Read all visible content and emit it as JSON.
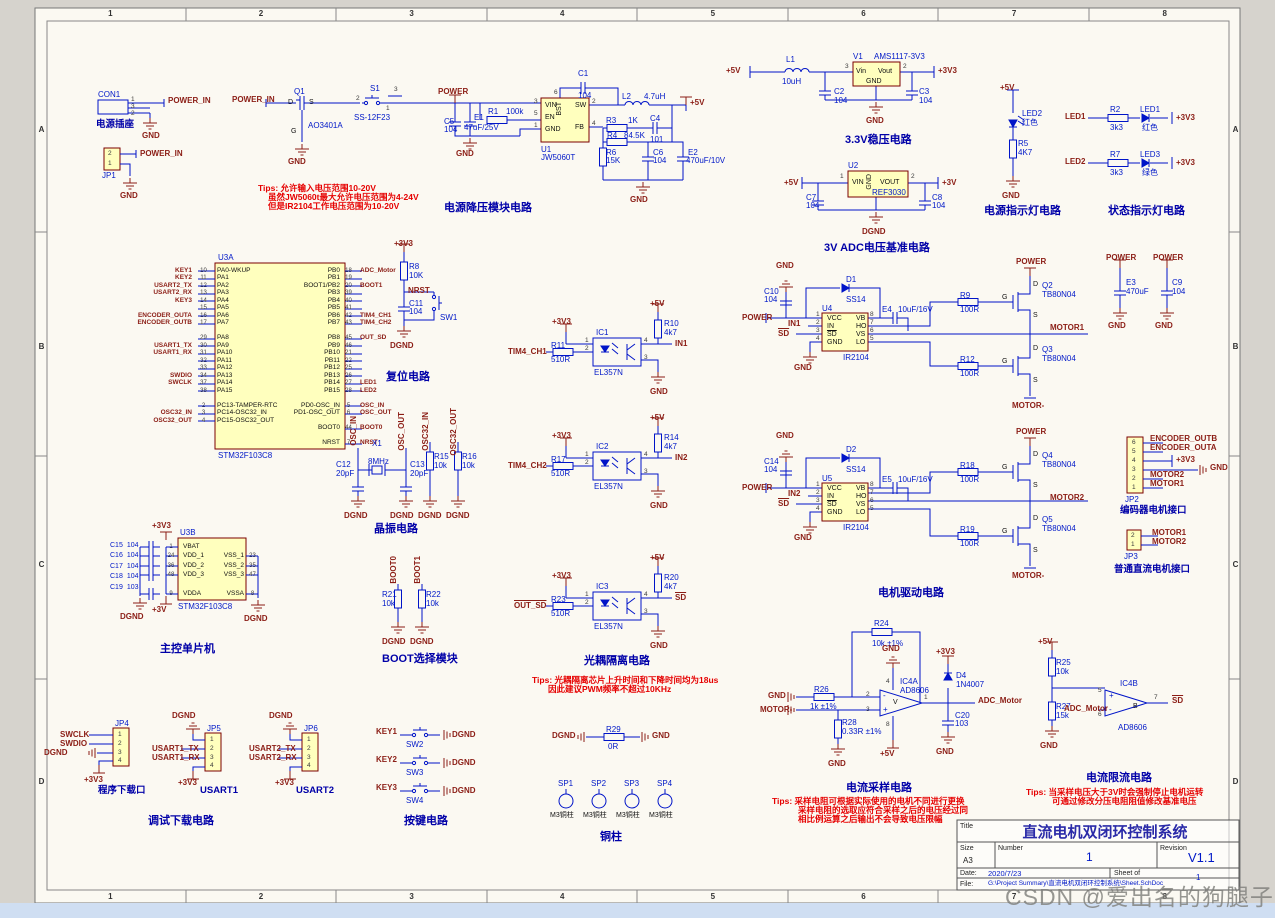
{
  "page": {
    "watermark": "CSDN @爱出名的狗腿子",
    "frame_cols": [
      "1",
      "2",
      "3",
      "4",
      "5",
      "6",
      "7",
      "8"
    ],
    "frame_rows": [
      "A",
      "B",
      "C",
      "D"
    ],
    "colors": {
      "wire": "#0014c8",
      "net_label": "#8b1d15",
      "ic_fill": "#ffffbe",
      "ic_border": "#7b0000",
      "section_title": "#0000a8",
      "tip": "#e60000",
      "sheet": "#fbf9f2"
    }
  },
  "pi": {
    "con1": "CON1",
    "jack_label": "电源插座",
    "p1": "1",
    "p3": "3",
    "p2": "2",
    "net": "POWER_IN",
    "gnd": "GND",
    "jp1": "JP1",
    "jp1_p2": "2",
    "jp1_p1": "1",
    "jp1_net": "POWER_IN",
    "jp1_gnd": "GND"
  },
  "bk": {
    "title": "电源降压模块电路",
    "in_net": "POWER_IN",
    "q1": "Q1",
    "q1v": "AO3401A",
    "q1_d": "D",
    "q1_g": "G",
    "q1_s": "S",
    "q1_gnd": "GND",
    "s1": "S1",
    "s1v": "SS-12F23",
    "s1_p1": "1",
    "s1_p2": "2",
    "s1_p3": "3",
    "power": "POWER",
    "c5": "C5",
    "c5v": "104",
    "e1": "E1",
    "e1v": "47uF/25V",
    "r1": "R1",
    "r1v": "100k",
    "u1": "U1",
    "u1v": "JW5060T",
    "vin": "VIN",
    "en": "EN",
    "gnd": "GND",
    "bst": "BST",
    "sw": "SW",
    "fb": "FB",
    "n3": "3",
    "n5": "5",
    "n1": "1",
    "n6": "6",
    "n2": "2",
    "n4": "4",
    "c1": "C1",
    "c1v": "104",
    "l2": "L2",
    "l2v": "4.7uH",
    "out": "+5V",
    "r3": "R3",
    "r3v": "1K",
    "c4": "C4",
    "c4v": "101",
    "r4": "R4",
    "r4v": "84.5K",
    "r6": "R6",
    "r6v": "15K",
    "c6": "C6",
    "c6v": "104",
    "e2": "E2",
    "e2v": "470uF/10V",
    "gnd2": "GND",
    "gnd3": "GND",
    "tip1": "Tips: 允许输入电压范围10-20V",
    "tip2": "虽然JW5060t最大允许电压范围为4-24V",
    "tip3": "但是IR2104工作电压范围为10-20V"
  },
  "ldo": {
    "title": "3.3V稳压电路",
    "in": "+5V",
    "l1": "L1",
    "l1v": "10uH",
    "v1": "V1",
    "v1v": "AMS1117-3V3",
    "vin": "Vin",
    "vout": "Vout",
    "gnd": "GND",
    "n3": "3",
    "n2": "2",
    "c2": "C2",
    "c2v": "104",
    "c3": "C3",
    "c3v": "104",
    "out": "+3V3",
    "gndlbl": "GND"
  },
  "ref": {
    "title": "3V ADC电压基准电路",
    "u2": "U2",
    "u2v": "REF3030",
    "vin": "VIN",
    "vout": "VOUT",
    "gnd": "GND",
    "n1": "1",
    "n2": "2",
    "in": "+5V",
    "out": "+3V",
    "c7": "C7",
    "c7v": "104",
    "c8": "C8",
    "c8v": "104",
    "dgnd": "DGND"
  },
  "pled": {
    "title": "电源指示灯电路",
    "vcc": "+5V",
    "led": "LED2",
    "color": "红色",
    "r5": "R5",
    "r5v": "4K7",
    "gnd": "GND"
  },
  "sled": {
    "title": "状态指示灯电路",
    "rows": [
      {
        "net": "LED1",
        "r": "R2",
        "rv": "3k3",
        "led": "LED1",
        "color": "红色",
        "vcc": "+3V3"
      },
      {
        "net": "LED2",
        "r": "R7",
        "rv": "3k3",
        "led": "LED3",
        "color": "绿色",
        "vcc": "+3V3"
      }
    ]
  },
  "mcu": {
    "u3a": "U3A",
    "part": "STM32F103C8",
    "title": "主控单片机",
    "u3b": "U3B",
    "partb": "STM32F103C8",
    "vcc": "+3V3",
    "vdda": "+3V",
    "dgndl": "DGND",
    "dgndr": "DGND",
    "left": [
      {
        "net": "KEY1",
        "pin": "10",
        "name": "PA0-WKUP"
      },
      {
        "net": "KEY2",
        "pin": "11",
        "name": "PA1"
      },
      {
        "net": "USART2_TX",
        "pin": "12",
        "name": "PA2"
      },
      {
        "net": "USART2_RX",
        "pin": "13",
        "name": "PA3"
      },
      {
        "net": "KEY3",
        "pin": "14",
        "name": "PA4"
      },
      {
        "net": "",
        "pin": "15",
        "name": "PA5"
      },
      {
        "net": "ENCODER_OUTA",
        "pin": "16",
        "name": "PA6"
      },
      {
        "net": "ENCODER_OUTB",
        "pin": "17",
        "name": "PA7"
      },
      {
        "net": "",
        "pin": "",
        "name": ""
      },
      {
        "net": "",
        "pin": "29",
        "name": "PA8"
      },
      {
        "net": "USART1_TX",
        "pin": "30",
        "name": "PA9"
      },
      {
        "net": "USART1_RX",
        "pin": "31",
        "name": "PA10"
      },
      {
        "net": "",
        "pin": "32",
        "name": "PA11"
      },
      {
        "net": "",
        "pin": "33",
        "name": "PA12"
      },
      {
        "net": "SWDIO",
        "pin": "34",
        "name": "PA13"
      },
      {
        "net": "SWCLK",
        "pin": "37",
        "name": "PA14"
      },
      {
        "net": "",
        "pin": "38",
        "name": "PA15"
      },
      {
        "net": "",
        "pin": "",
        "name": ""
      },
      {
        "net": "",
        "pin": "2",
        "name": "PC13-TAMPER-RTC"
      },
      {
        "net": "OSC32_IN",
        "pin": "3",
        "name": "PC14-OSC32_IN"
      },
      {
        "net": "OSC32_OUT",
        "pin": "4",
        "name": "PC15-OSC32_OUT"
      }
    ],
    "right": [
      {
        "name": "PB0",
        "pin": "18",
        "net": "ADC_Motor"
      },
      {
        "name": "PB1",
        "pin": "19",
        "net": ""
      },
      {
        "name": "BOOT1/PB2",
        "pin": "20",
        "net": "BOOT1"
      },
      {
        "name": "PB3",
        "pin": "39",
        "net": ""
      },
      {
        "name": "PB4",
        "pin": "40",
        "net": ""
      },
      {
        "name": "PB5",
        "pin": "41",
        "net": ""
      },
      {
        "name": "PB6",
        "pin": "42",
        "net": "TIM4_CH1"
      },
      {
        "name": "PB7",
        "pin": "43",
        "net": "TIM4_CH2"
      },
      {
        "name": "",
        "pin": "",
        "net": ""
      },
      {
        "name": "PB8",
        "pin": "45",
        "net": "OUT_SD"
      },
      {
        "name": "PB9",
        "pin": "46",
        "net": ""
      },
      {
        "name": "PB10",
        "pin": "21",
        "net": ""
      },
      {
        "name": "PB11",
        "pin": "22",
        "net": ""
      },
      {
        "name": "PB12",
        "pin": "25",
        "net": ""
      },
      {
        "name": "PB13",
        "pin": "26",
        "net": ""
      },
      {
        "name": "PB14",
        "pin": "27",
        "net": "LED1"
      },
      {
        "name": "PB15",
        "pin": "28",
        "net": "LED2"
      },
      {
        "name": "",
        "pin": "",
        "net": ""
      },
      {
        "name": "PD0-OSC_IN",
        "pin": "5",
        "net": "OSC_IN"
      },
      {
        "name": "PD1-OSC_OUT",
        "pin": "6",
        "net": "OSC_OUT"
      },
      {
        "name": "",
        "pin": "",
        "net": ""
      },
      {
        "name": "BOOT0",
        "pin": "44",
        "net": "BOOT0"
      },
      {
        "name": "",
        "pin": "",
        "net": ""
      },
      {
        "name": "NRST",
        "pin": "7",
        "net": "NRST"
      }
    ],
    "bleft": [
      {
        "pin": "1",
        "name": "VBAT"
      },
      {
        "pin": "24",
        "name": "VDD_1"
      },
      {
        "pin": "36",
        "name": "VDD_2"
      },
      {
        "pin": "48",
        "name": "VDD_3"
      },
      {
        "pin": "",
        "name": ""
      },
      {
        "pin": "9",
        "name": "VDDA"
      }
    ],
    "bright": [
      {
        "name": "",
        "pin": ""
      },
      {
        "name": "VSS_1",
        "pin": "23"
      },
      {
        "name": "VSS_2",
        "pin": "35"
      },
      {
        "name": "VSS_3",
        "pin": "47"
      },
      {
        "name": "",
        "pin": ""
      },
      {
        "name": "VSSA",
        "pin": "8"
      }
    ],
    "caps": [
      {
        "r": "C15",
        "v": "104"
      },
      {
        "r": "C16",
        "v": "104"
      },
      {
        "r": "C17",
        "v": "104"
      },
      {
        "r": "C18",
        "v": "104"
      },
      {
        "r": "C19",
        "v": "103"
      }
    ]
  },
  "rst": {
    "title": "复位电路",
    "vcc": "+3V3",
    "r8": "R8",
    "r8v": "10K",
    "net": "NRST",
    "c11": "C11",
    "c11v": "104",
    "sw": "SW1",
    "dgnd": "DGND"
  },
  "xtl": {
    "title": "晶振电路",
    "oscin": "OSC_IN",
    "oscout": "OSC_OUT",
    "x1": "X1",
    "x1v": "8MHz",
    "c12": "C12",
    "c12v": "20pF",
    "c13": "C13",
    "c13v": "20pF",
    "osc32in": "OSC32_IN",
    "osc32out": "OSC32_OUT",
    "r15": "R15",
    "r15v": "10k",
    "r16": "R16",
    "r16v": "10k",
    "g1": "DGND",
    "g2": "DGND",
    "g3": "DGND",
    "g4": "DGND"
  },
  "boot": {
    "title": "BOOT选择模块",
    "b0": "BOOT0",
    "b1": "BOOT1",
    "r21": "R21",
    "r21v": "10k",
    "r22": "R22",
    "r22v": "10k",
    "g1": "DGND",
    "g2": "DGND"
  },
  "opto": {
    "title": "光耦隔离电路",
    "tip1": "Tips: 光耦隔离芯片上升时间和下降时间均为18us",
    "tip2": "因此建议PWM频率不超过10KHz",
    "rows": [
      {
        "ic": "IC1",
        "part": "EL357N",
        "in": "TIM4_CH1",
        "rin": "R11",
        "rinv": "510R",
        "rup": "R10",
        "rupv": "4k7",
        "out": "IN1",
        "v3": "+3V3",
        "v5": "+5V",
        "gnd": "GND",
        "p1": "1",
        "p2": "2",
        "p3": "3",
        "p4": "4"
      },
      {
        "ic": "IC2",
        "part": "EL357N",
        "in": "TIM4_CH2",
        "rin": "R17",
        "rinv": "510R",
        "rup": "R14",
        "rupv": "4k7",
        "out": "IN2",
        "v3": "+3V3",
        "v5": "+5V",
        "gnd": "GND",
        "p1": "1",
        "p2": "2",
        "p3": "3",
        "p4": "4"
      },
      {
        "ic": "IC3",
        "part": "EL357N",
        "in": "OUT_SD",
        "rin": "R23",
        "rinv": "510R",
        "rup": "R20",
        "rupv": "4k7",
        "out": "SD",
        "v3": "+3V3",
        "v5": "+5V",
        "gnd": "GND",
        "p1": "1",
        "p2": "2",
        "p3": "3",
        "p4": "4"
      }
    ]
  },
  "drv": {
    "title": "电机驱动电路",
    "ch": [
      {
        "u": "U4",
        "part": "IR2104",
        "cap": "C10",
        "capv": "104",
        "gnd_top": "GND",
        "power": "POWER",
        "in": "IN1",
        "sd": "SD",
        "gnd_pin": "GND",
        "d": "D1",
        "dv": "SS14",
        "e": "E4",
        "ev": "10uF/16V",
        "rh": "R9",
        "rhv": "100R",
        "rl": "R12",
        "rlv": "100R",
        "qh": "Q2",
        "qhv": "TB80N04",
        "ql": "Q3",
        "qlv": "TB80N04",
        "pwr_top": "POWER",
        "motor": "MOTOR1",
        "motorneg": "MOTOR-",
        "vcc": "VCC",
        "inp": "IN",
        "sdp": "SD",
        "gndp": "GND",
        "vb": "VB",
        "ho": "HO",
        "vs": "VS",
        "lo": "LO",
        "p1": "1",
        "p2": "2",
        "p3": "3",
        "p4": "4",
        "p8": "8",
        "p7": "7",
        "p6": "6",
        "p5": "5",
        "dl": "D",
        "gl": "G",
        "sl": "S"
      },
      {
        "u": "U5",
        "part": "IR2104",
        "cap": "C14",
        "capv": "104",
        "gnd_top": "GND",
        "power": "POWER",
        "in": "IN2",
        "sd": "SD",
        "gnd_pin": "GND",
        "d": "D2",
        "dv": "SS14",
        "e": "E5",
        "ev": "10uF/16V",
        "rh": "R18",
        "rhv": "100R",
        "rl": "R19",
        "rlv": "100R",
        "qh": "Q4",
        "qhv": "TB80N04",
        "ql": "Q5",
        "qlv": "TB80N04",
        "pwr_top": "POWER",
        "motor": "MOTOR2",
        "motorneg": "MOTOR-",
        "vcc": "VCC",
        "inp": "IN",
        "sdp": "SD",
        "gndp": "GND",
        "vb": "VB",
        "ho": "HO",
        "vs": "VS",
        "lo": "LO",
        "p1": "1",
        "p2": "2",
        "p3": "3",
        "p4": "4",
        "p8": "8",
        "p7": "7",
        "p6": "6",
        "p5": "5",
        "dl": "D",
        "gl": "G",
        "sl": "S"
      }
    ]
  },
  "jp2": {
    "ref": "JP2",
    "title": "编码器电机接口",
    "p6": "6",
    "p5": "5",
    "p4": "4",
    "p3": "3",
    "p2": "2",
    "p1": "1",
    "n6": "ENCODER_OUTB",
    "n5": "ENCODER_OUTA",
    "n4": "+3V3",
    "n3": "GND",
    "n2": "MOTOR2",
    "n1": "MOTOR1"
  },
  "jp3": {
    "ref": "JP3",
    "title": "普通直流电机接口",
    "p2": "2",
    "p1": "1",
    "n2": "MOTOR1",
    "n1": "MOTOR2"
  },
  "pc": {
    "pw1": "POWER",
    "pw2": "POWER",
    "e3": "E3",
    "e3v": "470uF",
    "c9": "C9",
    "c9v": "104",
    "g1": "GND",
    "g2": "GND"
  },
  "dbg": {
    "title": "调试下载电路",
    "jp4": "JP4",
    "jp4_title": "程序下载口",
    "swclk": "SWCLK",
    "swdio": "SWDIO",
    "dgnd": "DGND",
    "v33": "+3V3",
    "p1": "1",
    "p2": "2",
    "p3": "3",
    "p4": "4",
    "jp5": "JP5",
    "jp5_title": "USART1",
    "u1tx": "USART1_TX",
    "u1rx": "USART1_RX",
    "dgnd5": "DGND",
    "v335": "+3V3",
    "jp6": "JP6",
    "jp6_title": "USART2",
    "u2tx": "USART2_TX",
    "u2rx": "USART2_RX",
    "dgnd6": "DGND",
    "v336": "+3V3"
  },
  "keys": {
    "title": "按键电路",
    "rows": [
      {
        "net": "KEY1",
        "sw": "SW2",
        "gnd": "DGND"
      },
      {
        "net": "KEY2",
        "sw": "SW3",
        "gnd": "DGND"
      },
      {
        "net": "KEY3",
        "sw": "SW4",
        "gnd": "DGND"
      }
    ]
  },
  "sp": {
    "title": "铜柱",
    "dgnd": "DGND",
    "gnd": "GND",
    "r29": "R29",
    "r29v": "0R",
    "items": [
      {
        "ref": "SP1",
        "val": "M3铜柱"
      },
      {
        "ref": "SP2",
        "val": "M3铜柱"
      },
      {
        "ref": "SP3",
        "val": "M3铜柱"
      },
      {
        "ref": "SP4",
        "val": "M3铜柱"
      }
    ]
  },
  "smp": {
    "title": "电流采样电路",
    "r24": "R24",
    "r24v": "10k ±1%",
    "gnd_top": "GND",
    "gnd_l": "GND",
    "motor": "MOTOR-",
    "r26": "R26",
    "r26v": "1k ±1%",
    "r28": "R28",
    "r28v": "0.33R ±1%",
    "gnd_b": "GND",
    "ic": "IC4A",
    "part": "AD8606",
    "plus": "+",
    "minus": "-",
    "vsym": "V",
    "p1": "1",
    "p2": "2",
    "p3": "3",
    "p4": "4",
    "p8": "8",
    "v5": "+5V",
    "v33": "+3V3",
    "d4": "D4",
    "d4v": "1N4007",
    "c20": "C20",
    "c20v": "103",
    "gnd_c": "GND",
    "out": "ADC_Motor",
    "tip1": "Tips: 采样电阻可根据实际使用的电机不同进行更换",
    "tip2": "采样电阻的选取应符合采样之后的电压经过同",
    "tip3": "相比例运算之后输出不会导致电压限幅"
  },
  "lim": {
    "title": "电流限流电路",
    "v5": "+5V",
    "r25": "R25",
    "r25v": "10k",
    "r27": "R27",
    "r27v": "15k",
    "gnd": "GND",
    "ic": "IC4B",
    "part": "AD8606",
    "b": "B",
    "in": "ADC_Motor",
    "out": "SD",
    "p5": "5",
    "p6": "6",
    "p7": "7",
    "plus": "+",
    "minus": "-",
    "tip1": "Tips: 当采样电压大于3V时会强制停止电机运转",
    "tip2": "可通过修改分压电阻阻值修改基准电压"
  },
  "tb": {
    "title_label": "Title",
    "title": "直流电机双闭环控制系统",
    "size_label": "Size",
    "size": "A3",
    "number_label": "Number",
    "number": "1",
    "revision_label": "Revision",
    "revision": "V1.1",
    "date_label": "Date:",
    "date": "2020/7/23",
    "sheet_label": "Sheet  of",
    "sheet": "1",
    "file_label": "File:",
    "file": "G:\\Project Summary\\直流电机双闭环控制系统\\Sheet.SchDoc"
  }
}
